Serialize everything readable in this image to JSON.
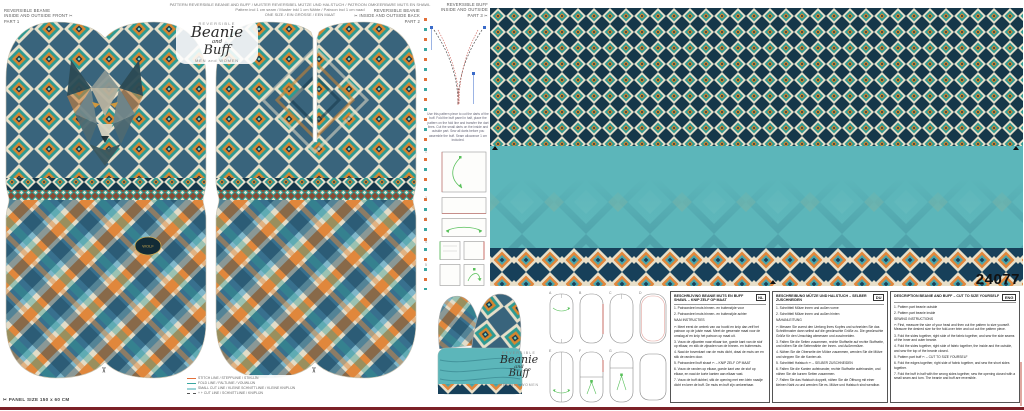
{
  "header": {
    "l1": "PATTERN REVERSIBLE BEANIE AND BUFF / MUSTER REVERSIBEL MÜTZE UND HALSTUCH / PATROON OMKEERBARE MUTS EN SHAWL",
    "l2": "Pattern incl 1 cm seam / Muster inkl 1 cm Nähte / Patroon incl 1 cm naad",
    "l3": "ONE SIZE / EIN GRÖSSE / EEN MAAT"
  },
  "labels": {
    "part1": {
      "l1": "REVERSIBLE BEANIE",
      "l2": "INSIDE and OUTSIDE FRONT ✂",
      "l3": "PART 1"
    },
    "part2": {
      "l1": "REVERSIBLE BEANIE",
      "l2": "✂ INSIDE and OUTSIDE BACK",
      "l3": "PART 2"
    },
    "part3": {
      "l1": "REVERSIBLE BUFF",
      "l2": "INSIDE AND OUTSIDE",
      "l3": "PART 3 ✂"
    }
  },
  "brand": {
    "reversible": "REVERSIBLE",
    "name1": "Beanie",
    "and": "and",
    "name2": "Buff",
    "audience": "MEN and WOMEN"
  },
  "panel": {
    "number": "24077",
    "size": "✂  PANEL SIZE 150 x 60 CM"
  },
  "badge": {
    "text": "WOLF"
  },
  "legend": {
    "items": [
      {
        "text": "STITCH LINE / STEPPLINIE / STIKLIJN"
      },
      {
        "text": "FOLD LINE / FALTLINIE / VOUWLIJN"
      },
      {
        "text": "SMALL CUT LINE / KLEINE SCHNITTLINIE / KLEINE KNIPLIJN"
      },
      {
        "text": "+ + CUT LINE / SCHNITTLINIE / KNIPLIJN"
      }
    ]
  },
  "dart_note": "Use this pattern piece to cut the darts of the buff. Fold the buff panel in half, place the pattern on the fold line and transfer the dart lines. Cut the small darts on the inside and outside part. Sew all darts before you assemble the buff. Seam allowance 1 cm included.",
  "mid_steps": [
    "1",
    "2",
    "3",
    "4",
    "5"
  ],
  "outline_labels": [
    "A",
    "B",
    "C",
    "D",
    "E",
    "F",
    "G",
    ""
  ],
  "instructions": {
    "columns": [
      {
        "lang": "NL",
        "header": "BESCHRIJVING BEANIE MUTS EN BUFF SHAWL – KNIP ZELF OP MAAT",
        "lines": [
          "1. Patroondeel muts binnen- en buitenzijde voor",
          "2. Patroondeel muts binnen- en buitenzijde achter",
          "NAAI INSTRUCTIES",
          "✂  Meet eerst de omtrek van uw hoofd en knip dan zelf het patroon op de juiste maat. Meet de gewenste maat voor de omslag af en knip het patroon op maat uit.",
          "3. Vouw de zijkanten naar elkaar toe, goede kant van de stof op elkaar, en stik de zijnaden van de binnen- en buitenmuts.",
          "4. Naai de bovenkant van de muts dicht, draai de muts om en stik de randen door.",
          "5. Patroondeel buff shawl  ✂  – KNIP ZELF OP MAAT",
          "6. Vouw de randen op elkaar, goede kant van de stof op elkaar, en naai de korte kanten aan elkaar vast.",
          "7. Vouw de buff dubbel, stik de opening met een klein naadje dicht en keer de buff. De muts en buff zijn omkeerbaar."
        ]
      },
      {
        "lang": "DU",
        "header": "BESCHREIBUNG MÜTZE UND HALSTUCH – SELBER ZUSCHNEIDEN",
        "lines": [
          "1. Schnittteil Mütze innen und außen vorne",
          "2. Schnittteil Mütze innen und außen hinten",
          "NÄHANLEITUNG",
          "✂  Messen Sie zuerst den Umfang Ihres Kopfes und schneiden Sie das Schnittmuster dann selbst auf die gewünschte Größe zu. Die gewünschte Größe für den Umschlag abmessen und zuschneiden.",
          "3. Falten Sie die Seiten zusammen, rechte Stoffseite auf rechte Stoffseite, und nähen Sie die Seitennähte der Innen- und Außenmütze.",
          "4. Nähen Sie die Oberseite der Mütze zusammen, wenden Sie die Mütze und steppen Sie die Kanten ab.",
          "5. Schnittteil Halstuch  ✂  – SELBER ZUSCHNEIDEN",
          "6. Falten Sie die Kanten aufeinander, rechte Stoffseite aufeinander, und nähen Sie die kurzen Seiten zusammen.",
          "7. Falten Sie das Halstuch doppelt, nähen Sie die Öffnung mit einer kleinen Naht zu und wenden Sie es. Mütze und Halstuch sind wendbar."
        ]
      },
      {
        "lang": "ENG",
        "header": "DESCRIPTION BEANIE AND BUFF – CUT TO SIZE YOURSELF",
        "lines": [
          "1. Pattern part beanie outside",
          "2. Pattern part beanie inside",
          "SEWING INSTRUCTIONS",
          "✂  First, measure the size of your head and then cut the pattern to size yourself. Measure the desired size for the fold-over brim and cut out the pattern piece.",
          "3. Fold the sides together, right side of the fabric together, and sew the side seams of the inner and outer beanie.",
          "4. Fold the sides together, right side of fabric together, the inside and the outside, and sew the top of the beanie closed.",
          "5. Pattern part buff  ✂  – CUT TO SIZE YOURSELF",
          "6. Fold the edges together, right side of fabric together, and sew the short sides together.",
          "7. Fold the buff in half with the wrong sides together, sew the opening closed with a small seam and turn. The beanie and buff are reversible."
        ]
      }
    ]
  },
  "colors": {
    "teal": "#2f9a92",
    "buff_teal": "#5cb6ba",
    "orange": "#d6862f",
    "navy": "#16384a",
    "cream": "#e7dfc9",
    "steel": "#38708e",
    "maroon": "#7c2128",
    "stitch_red": "#cc5a52",
    "fold_teal": "#3aa6a0",
    "small_cut": "#9fd4d8",
    "arrow_green": "#58c05a"
  }
}
